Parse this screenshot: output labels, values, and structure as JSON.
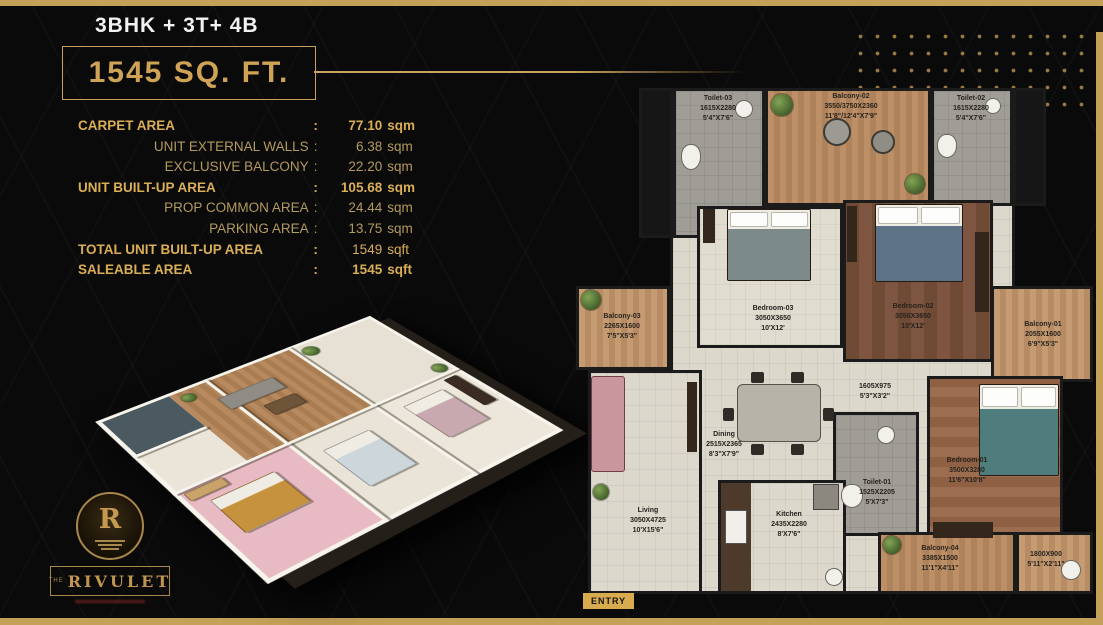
{
  "colors": {
    "gold": "#c9a25c",
    "bar_gold": "#c5a059",
    "background": "#0a0a0a",
    "label_ink": "#27231e"
  },
  "header": {
    "unit_type": "3BHK + 3T+ 4B",
    "area": "1545 SQ. FT."
  },
  "area_table": {
    "colon": ":",
    "rows": [
      {
        "label": "CARPET AREA",
        "value": "77.10",
        "unit": "sqm"
      },
      {
        "label": "UNIT EXTERNAL WALLS",
        "value": "6.38",
        "unit": "sqm"
      },
      {
        "label": "EXCLUSIVE BALCONY",
        "value": "22.20",
        "unit": "sqm"
      },
      {
        "label": "UNIT BUILT-UP AREA",
        "value": "105.68",
        "unit": "sqm"
      },
      {
        "label": "PROP COMMON AREA",
        "value": "24.44",
        "unit": "sqm"
      },
      {
        "label": "PARKING AREA",
        "value": "13.75",
        "unit": "sqm"
      },
      {
        "label": "TOTAL UNIT BUILT-UP AREA",
        "value": "1549",
        "unit": "sqft"
      },
      {
        "label": "SALEABLE AREA",
        "value": "1545",
        "unit": "sqft"
      }
    ]
  },
  "plan": {
    "entry": "ENTRY",
    "rooms": [
      {
        "name": "Toilet-03",
        "mm": "1615X2280",
        "ft": "5'4\"X7'6\""
      },
      {
        "name": "Balcony-02",
        "mm": "3550/3750X2360",
        "ft": "11'8\"/12'4\"X7'9\""
      },
      {
        "name": "Toilet-02",
        "mm": "1615X2280",
        "ft": "5'4\"X7'6\""
      },
      {
        "name": "Bedroom-03",
        "mm": "3050X3650",
        "ft": "10'X12'"
      },
      {
        "name": "Bedroom-02",
        "mm": "3050X3650",
        "ft": "10'X12'"
      },
      {
        "name": "Balcony-03",
        "mm": "2265X1600",
        "ft": "7'5\"X5'3\""
      },
      {
        "name": "Balcony-01",
        "mm": "2055X1600",
        "ft": "6'9\"X5'3\""
      },
      {
        "name": "",
        "mm": "1605X975",
        "ft": "5'3\"X3'2\""
      },
      {
        "name": "Dining",
        "mm": "2515X2365",
        "ft": "8'3\"X7'9\""
      },
      {
        "name": "Bedroom-01",
        "mm": "3500X3280",
        "ft": "11'6\"X10'8\""
      },
      {
        "name": "Toilet-01",
        "mm": "1525X2205",
        "ft": "5'X7'3\""
      },
      {
        "name": "Living",
        "mm": "3050X4725",
        "ft": "10'X15'6\""
      },
      {
        "name": "Kitchen",
        "mm": "2435X2280",
        "ft": "8'X7'6\""
      },
      {
        "name": "Balcony-04",
        "mm": "3385X1500",
        "ft": "11'1\"X4'11\""
      },
      {
        "name": "",
        "mm": "1800X900",
        "ft": "5'11\"X2'11\""
      }
    ]
  },
  "logo": {
    "prefix": "THE",
    "brand": "RIVULET"
  }
}
